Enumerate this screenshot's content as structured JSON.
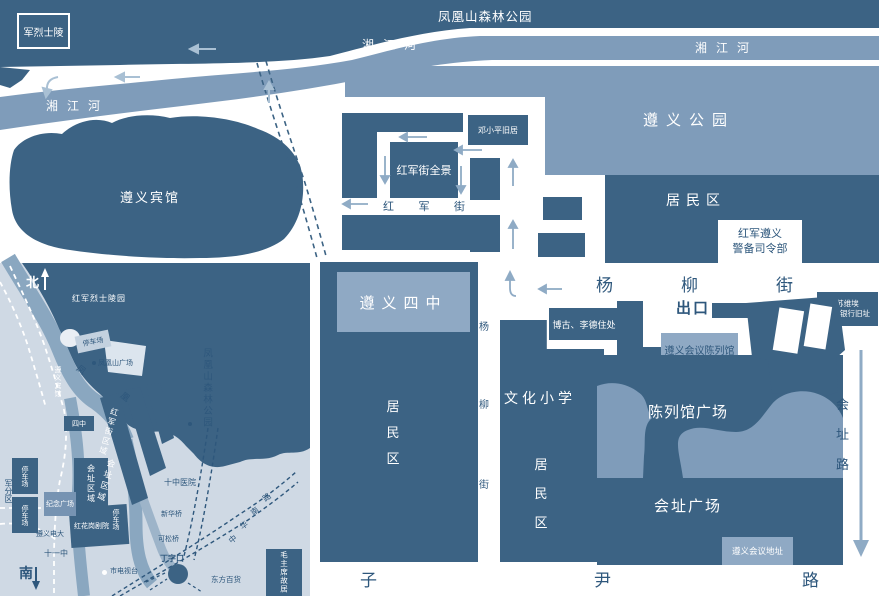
{
  "colors": {
    "block_dark": "#3c6384",
    "river_medium": "#7f9cba",
    "light_box": "#8fa9c4",
    "inset_bg": "#cfd9e4",
    "street_arrow": "#8fabc5",
    "river_arrow": "#a9c0d4",
    "text_dark": "#2e577c",
    "text_white": "#ffffff"
  },
  "main": {
    "forest_park": "凤凰山森林公园",
    "river": "湘江河",
    "martyrs": "军烈士陵",
    "hotel": "遵义宾馆",
    "park": "遵义公园",
    "residential": "居民区",
    "garrison_line1": "红军遵义",
    "garrison_line2": "警备司令部",
    "yangliu": [
      "杨",
      "柳",
      "街"
    ],
    "deng": "邓小平旧居",
    "panorama": "红军街全景",
    "redarmy_street": [
      "红",
      "军",
      "街"
    ],
    "no4_school": "遵义四中",
    "residential_v": [
      "居",
      "民",
      "区"
    ],
    "vstreet": [
      "杨",
      "柳",
      "街"
    ],
    "culture_school": "文化小学",
    "bogu": "博古、李德住处",
    "exit": "出口",
    "bank_line1": "苏维埃",
    "bank_line2": "国家银行旧址",
    "exhibition_hall": "遵义会议陈列馆",
    "exhibition_square": "陈列馆广场",
    "site_square": "会址广场",
    "site_addr": "遵义会议地址",
    "huizhi_road": [
      "会",
      "址",
      "路"
    ],
    "ziyin_road": [
      "子",
      "尹",
      "路"
    ]
  },
  "inset": {
    "north": "北",
    "south": "南",
    "martyrs_cemetery": "红军烈士陵园",
    "parking": "停车场",
    "fenghuang_square": "凤凰山广场",
    "forest_park_v": "凤凰山森林公园",
    "feng": "凤",
    "huang": "凰",
    "hotel_v": "遵义宾馆",
    "no4": "四中",
    "redarmy_area": "红军街区域",
    "site_area": "会址区域",
    "memorial_square": "纪念广场",
    "military": "军分区",
    "tv_station": "市电视台",
    "junction": "丁字口",
    "oriental_store": "东方百货",
    "mao_residence": "毛主席故居",
    "theater": "红花岗剧院",
    "zunyi_univ": "遵义电大",
    "no11": "十一中",
    "no10_hospital": "十中医院",
    "xinhua_bridge": "新华桥",
    "kesong_bridge": "可松桥",
    "zhonghua_road": [
      "中",
      "华",
      "南",
      "路"
    ]
  }
}
